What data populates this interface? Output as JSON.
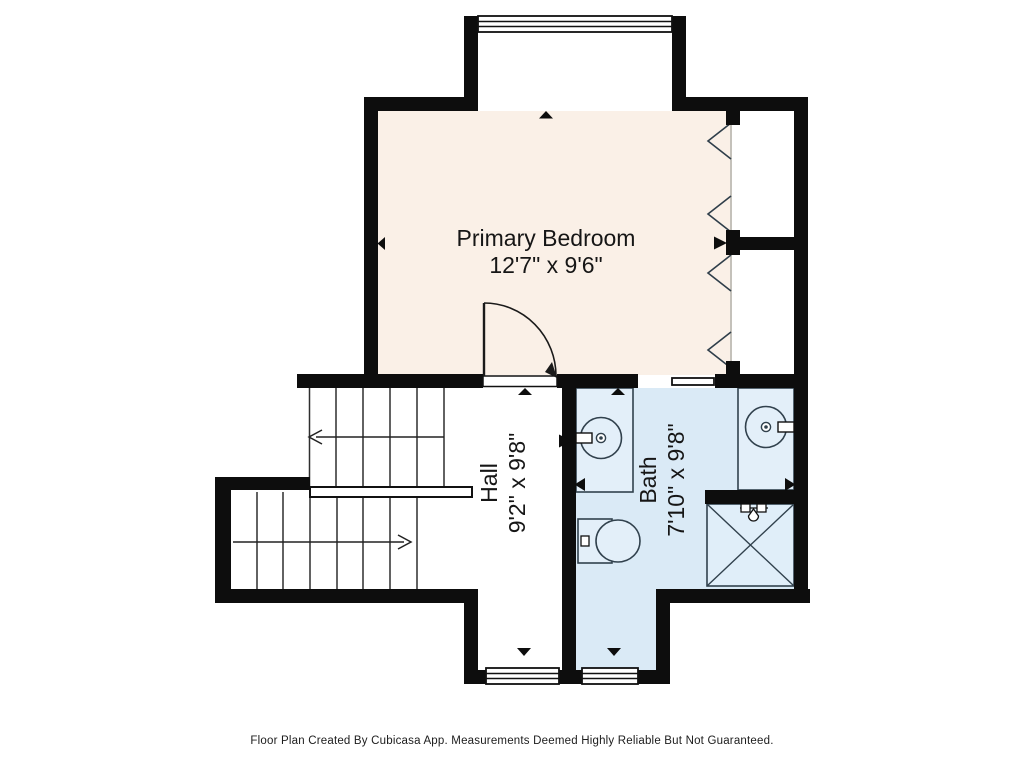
{
  "plan": {
    "rooms": [
      {
        "id": "primary-bedroom",
        "label": "Primary Bedroom",
        "dimensions": "12'7\" x 9'6\"",
        "fill": "#FAF0E7"
      },
      {
        "id": "hall",
        "label": "Hall",
        "dimensions": "9'2\" x 9'8\"",
        "fill": "#FFFFFF"
      },
      {
        "id": "bath",
        "label": "Bath",
        "dimensions": "7'10\" x 9'8\"",
        "fill": "#DAEAF6"
      }
    ],
    "colors": {
      "wall": "#0D0D0D",
      "bedroom_fill": "#FAF0E7",
      "bath_fill": "#DAEAF6",
      "fixture_fill": "#E3EFF9",
      "line": "#2F3E4A"
    },
    "fixtures": [
      "window-icon",
      "window-icon",
      "window-icon",
      "door-swing-icon",
      "sliding-door-icon",
      "bifold-doors-icon",
      "staircase",
      "sink-icon",
      "sink-icon",
      "toilet-icon",
      "shower-icon",
      "shower-head-icon"
    ]
  },
  "footer": {
    "text": "Floor Plan Created By Cubicasa App. Measurements Deemed Highly Reliable But Not Guaranteed."
  }
}
